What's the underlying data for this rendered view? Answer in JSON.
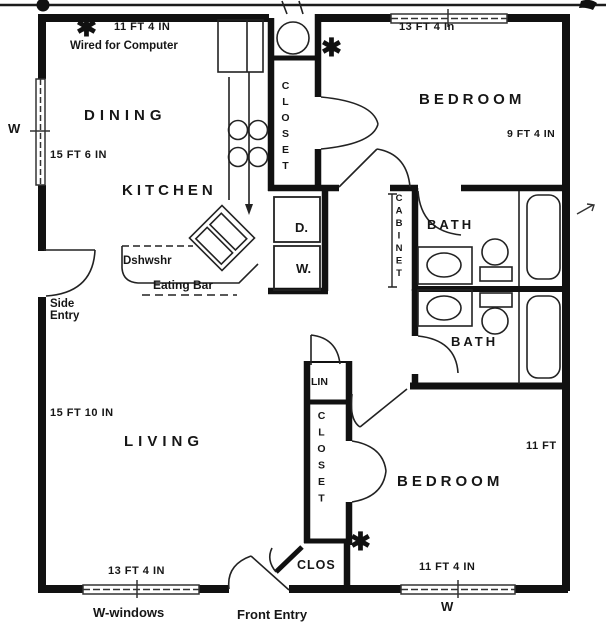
{
  "document": {
    "title": "Apartment floor plan (scanned)"
  },
  "colors": {
    "ink": "#161616",
    "paper": "#ffffff"
  },
  "rooms": {
    "dining": "DINING",
    "kitchen": "KITCHEN",
    "living": "LIVING",
    "bedroom_top": "BEDROOM",
    "bedroom_bottom": "BEDROOM",
    "bath_top": "BATH",
    "bath_bottom": "BATH",
    "closet_top": "CLOSET",
    "closet_bottom": "CLOSET",
    "cabinet": "CABINET",
    "linen": "LIN",
    "entry_closet": "CLOS"
  },
  "dimensions": {
    "dining_width": "11 FT 4 IN",
    "bedroom_top_width": "13 FT 4 In",
    "bedroom_top_depth": "9 FT 4 IN",
    "dining_depth": "15 FT 6 IN",
    "living_depth": "15 FT 10 IN",
    "living_width": "13 FT 4 IN",
    "bedroom_bottom_depth": "11 FT",
    "bedroom_bottom_width": "11 FT 4 IN"
  },
  "annotations": {
    "wired": "Wired for Computer",
    "dishwasher": "Dshwshr",
    "eating_bar": "Eating Bar",
    "side_entry": "Side Entry",
    "front_entry": "Front Entry",
    "windows_legend": "W-windows",
    "window_left": "W",
    "window_bottom": "W",
    "dryer": "D.",
    "washer": "W.",
    "asterisk": "✱"
  }
}
